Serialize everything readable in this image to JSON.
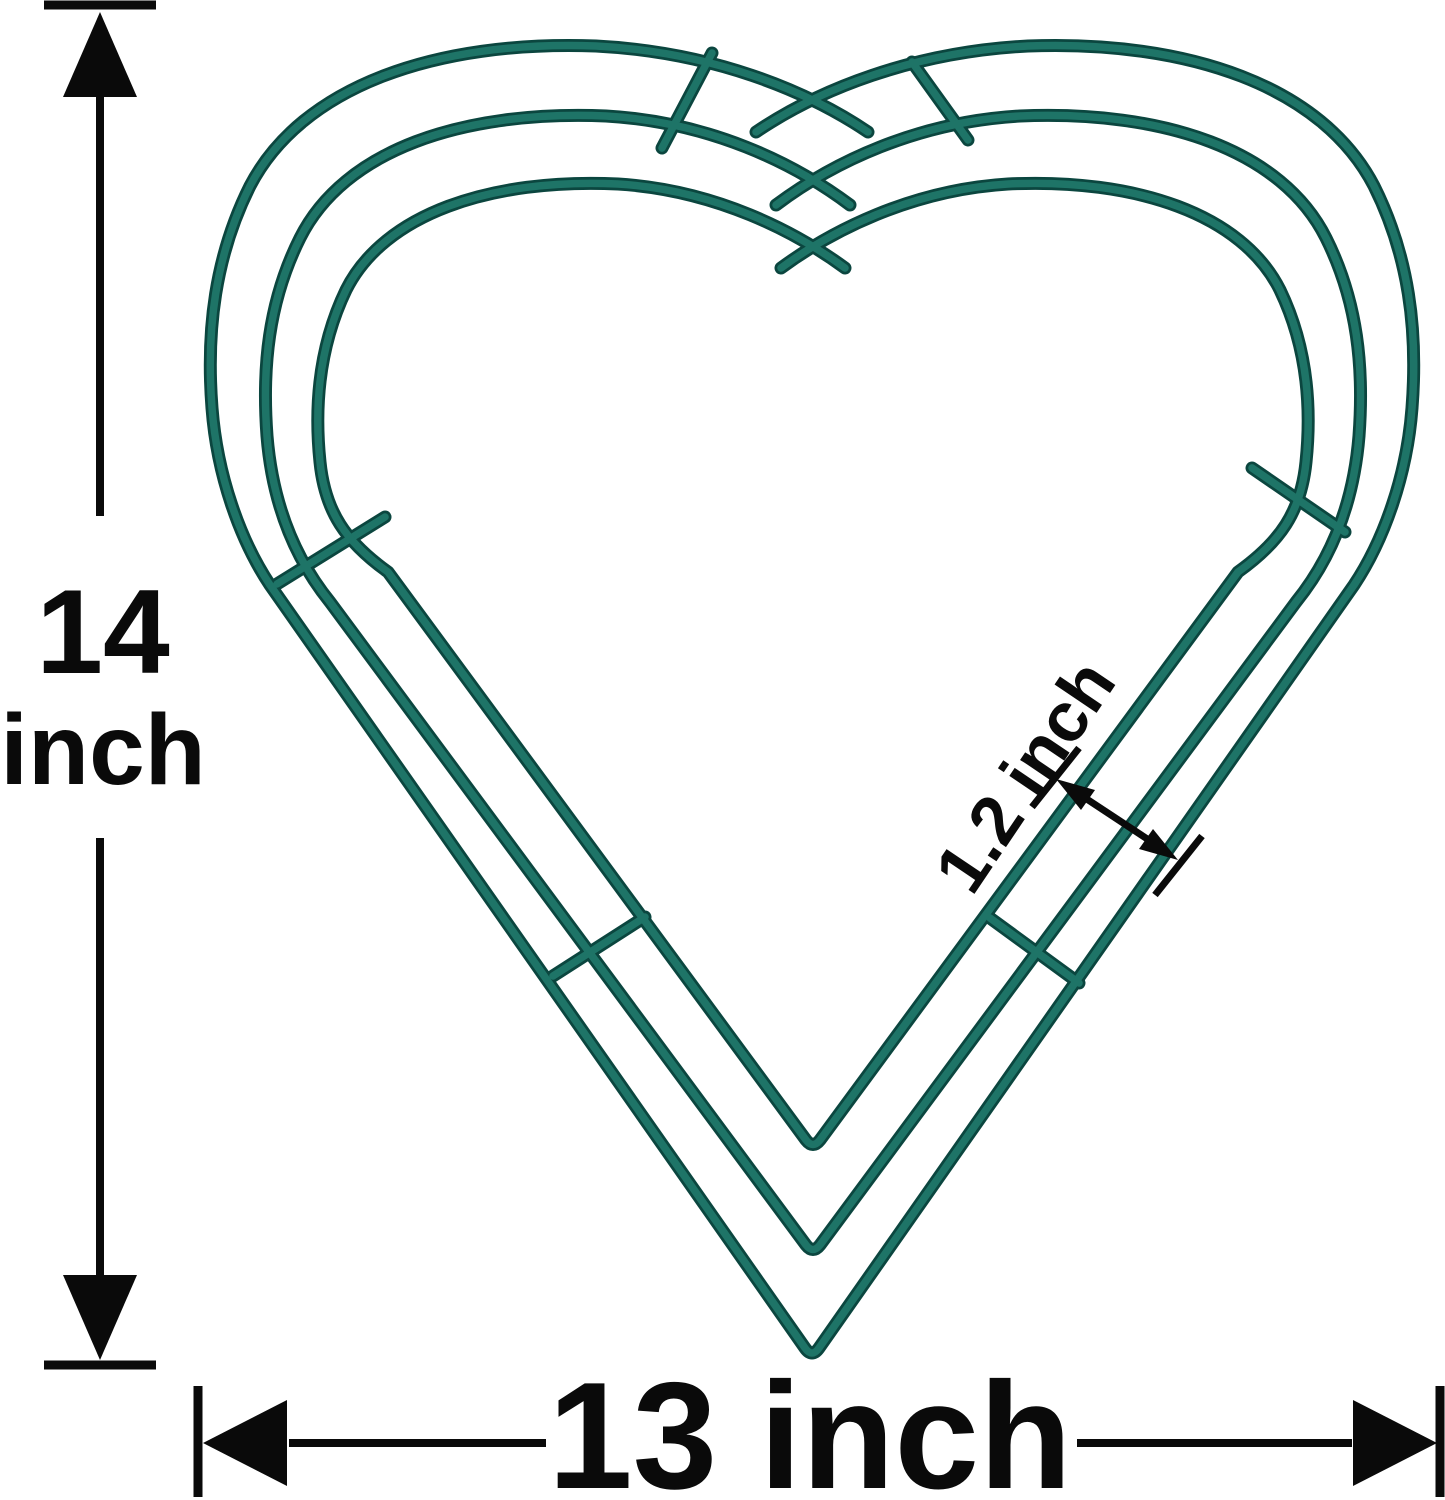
{
  "meta": {
    "description": "Dimension diagram of a heart-shaped metal wire wreath frame",
    "shape": "heart",
    "concentric_wires": 3,
    "cross_ties": 6
  },
  "colors": {
    "background": "#ffffff",
    "wire": "#1e7467",
    "wire_shadow": "#0b463f",
    "annotation": "#0a0a0a"
  },
  "labels": {
    "height": {
      "value": "14",
      "unit": "inch"
    },
    "width": "13 inch",
    "wire_gap": "1.2 inch"
  }
}
